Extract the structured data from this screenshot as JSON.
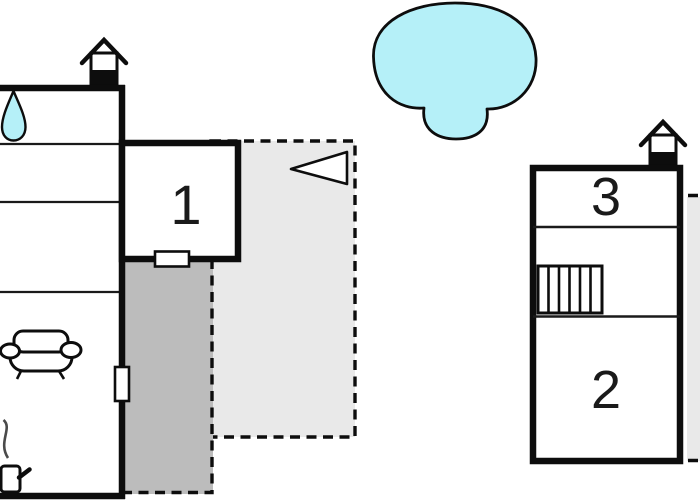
{
  "plan": {
    "title": "Holiday home floor plan",
    "rooms": [
      {
        "label": "1",
        "building": "left-annex"
      },
      {
        "label": "2",
        "building": "right-building"
      },
      {
        "label": "3",
        "building": "right-building"
      }
    ],
    "icons": [
      "chimney-icon",
      "chimney-icon",
      "water-drop-icon",
      "pool-shape",
      "sofa-icon",
      "wood-stove-icon",
      "stairs-icon",
      "direction-arrow-icon",
      "window-marker",
      "door-marker"
    ]
  },
  "colors": {
    "wall": "#0d0d0d",
    "thin_line": "#1a1a1a",
    "pool": "#b5f0f8",
    "terrace_dark": "#bcbcbc",
    "terrace_light": "#e9e9e9",
    "smoke": "#4a4a4a",
    "background": "#ffffff",
    "label_text": "#1a1a1a"
  }
}
